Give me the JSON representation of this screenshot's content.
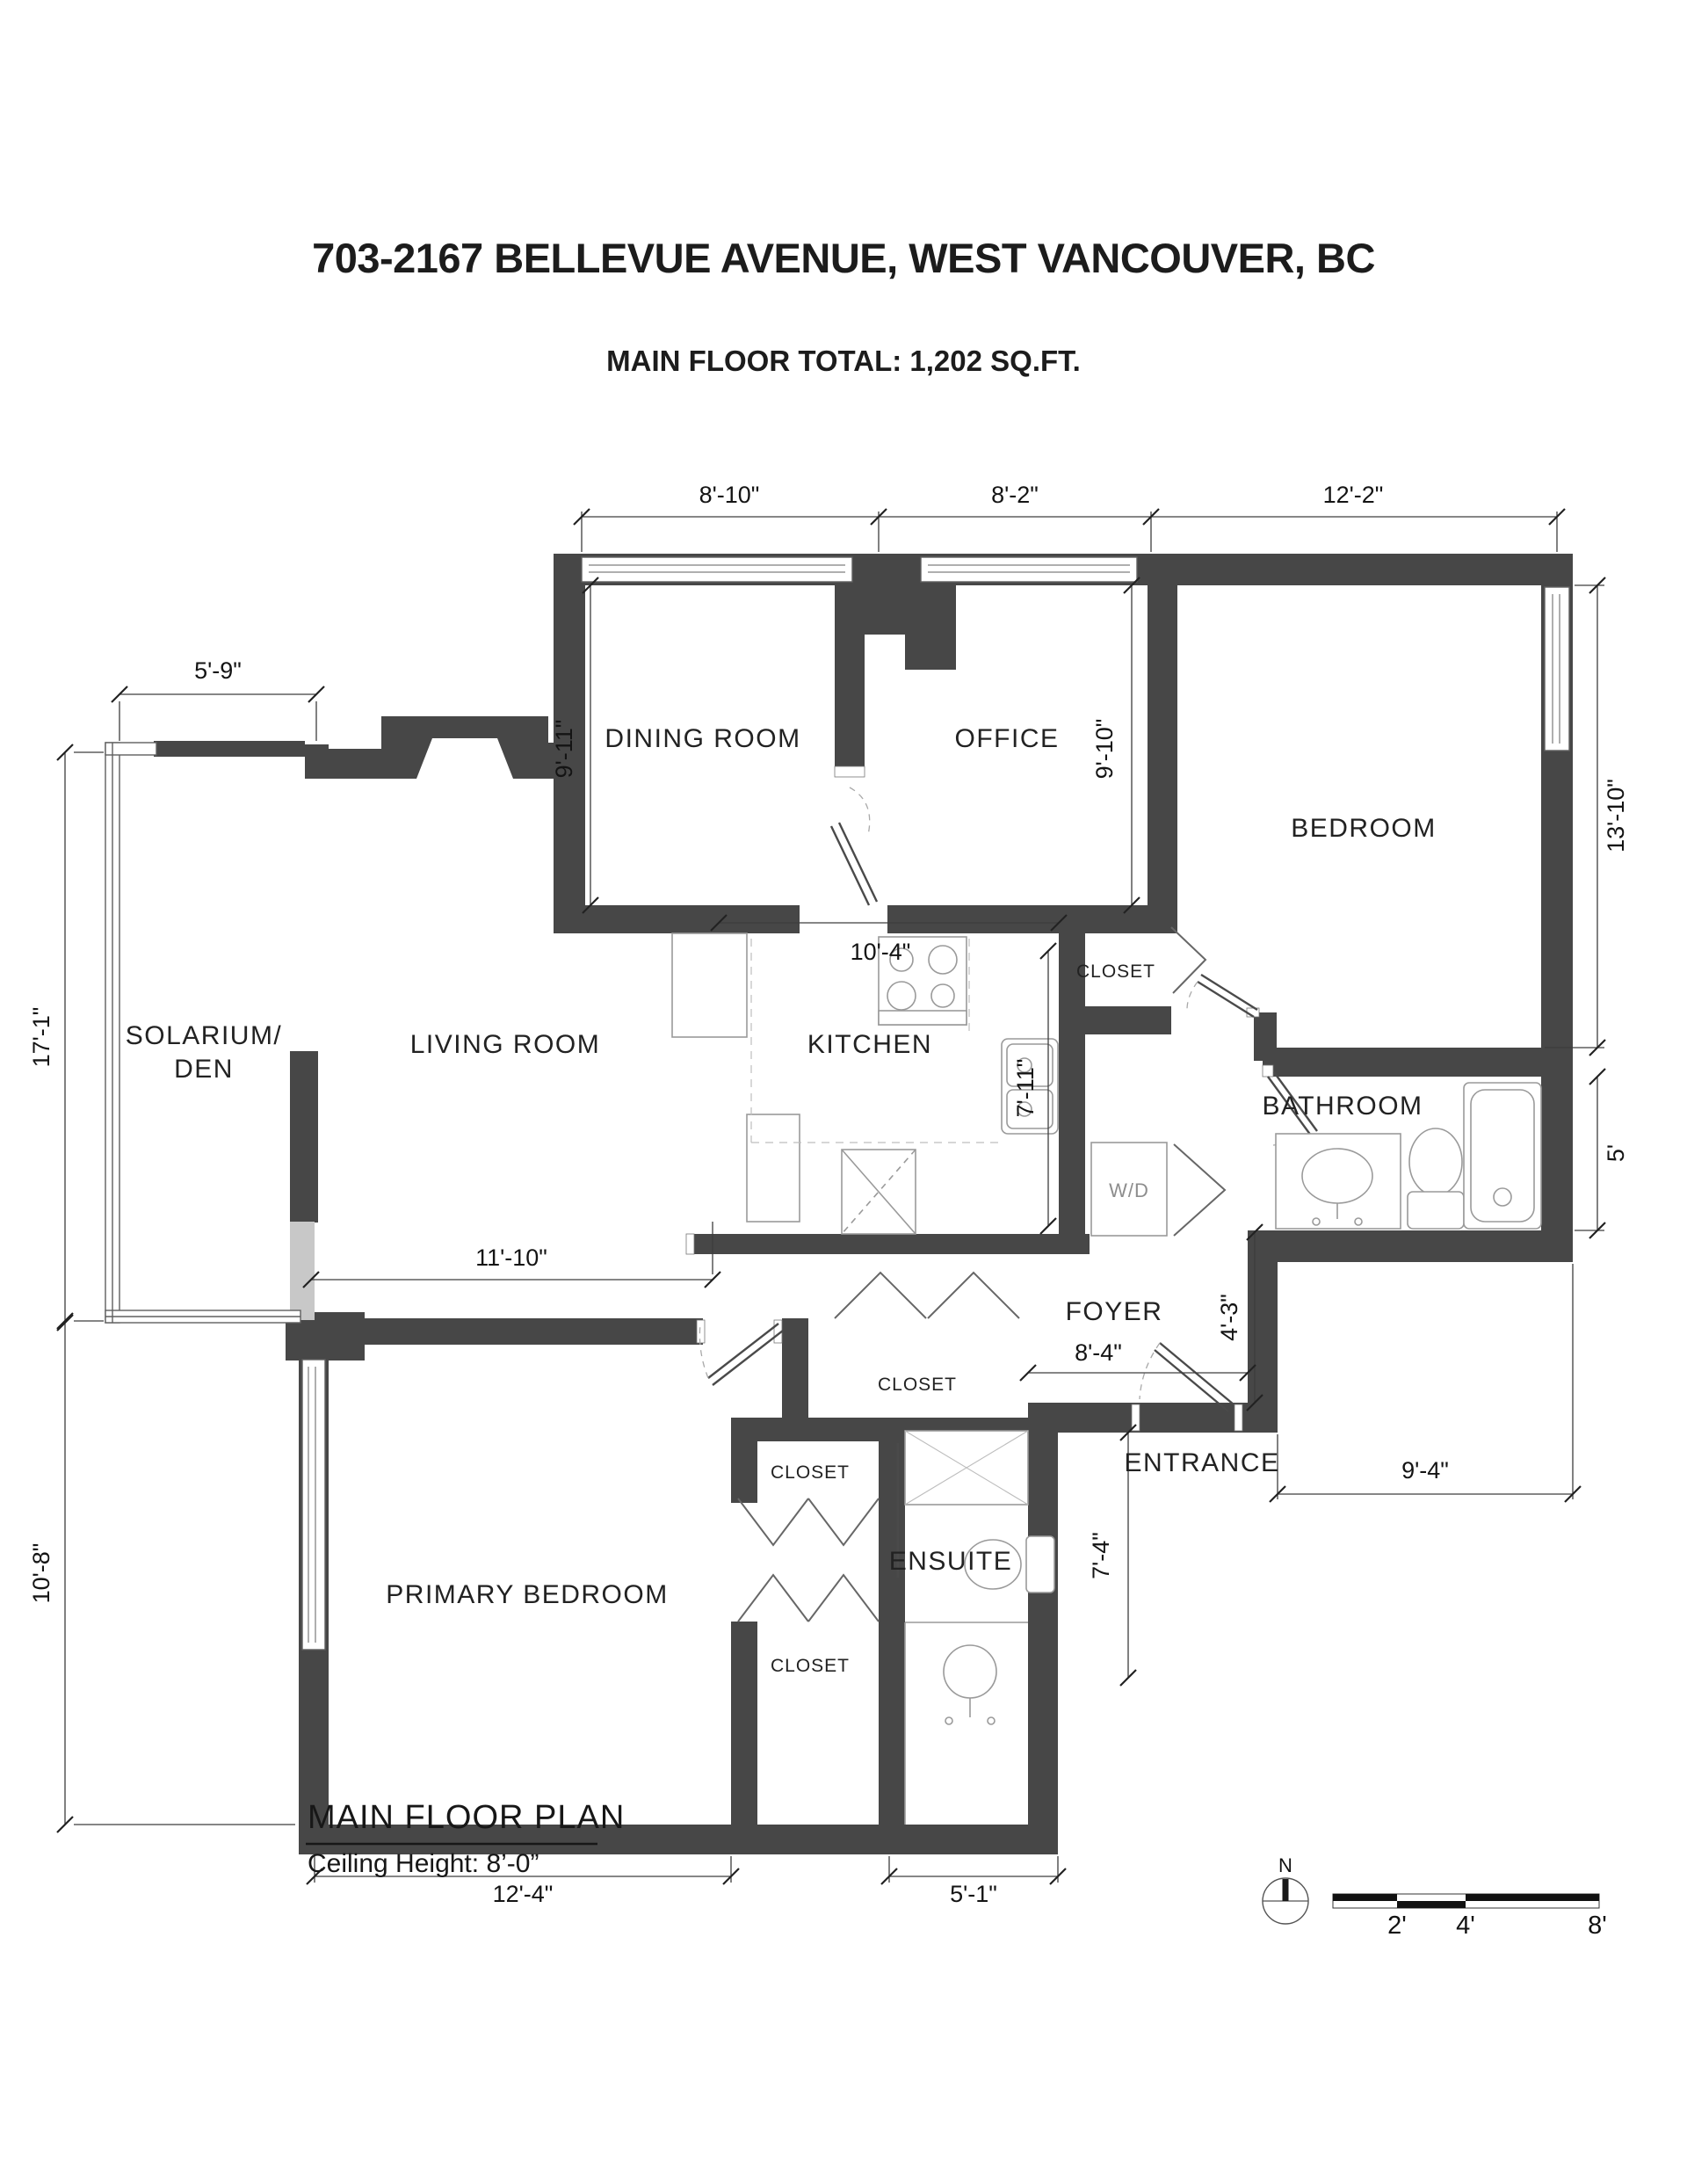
{
  "header": {
    "title": "703-2167 BELLEVUE AVENUE, WEST VANCOUVER, BC",
    "subtitle": "MAIN FLOOR TOTAL:  1,202 SQ.FT."
  },
  "rooms": {
    "dining": "DINING ROOM",
    "office": "OFFICE",
    "bedroom": "BEDROOM",
    "solarium_line1": "SOLARIUM/",
    "solarium_line2": "DEN",
    "living": "LIVING ROOM",
    "kitchen": "KITCHEN",
    "bathroom": "BATHROOM",
    "foyer": "FOYER",
    "entrance": "ENTRANCE",
    "primary": "PRIMARY BEDROOM",
    "ensuite": "ENSUITE",
    "closet_bedroom": "CLOSET",
    "closet_foyer": "CLOSET",
    "closet_primary_a": "CLOSET",
    "closet_primary_b": "CLOSET",
    "washer_dryer": "W/D"
  },
  "dims": {
    "d8_10": "8'-10\"",
    "d8_2": "8'-2\"",
    "d12_2": "12'-2\"",
    "d5_9": "5'-9\"",
    "d17_1": "17'-1\"",
    "d10_8": "10'-8\"",
    "d9_11": "9'-11\"",
    "d9_10": "9'-10\"",
    "d13_10": "13'-10\"",
    "d5": "5'",
    "d10_4": "10'-4\"",
    "d7_11": "7'-11\"",
    "d11_10": "11'-10\"",
    "d4_3": "4'-3\"",
    "d8_4": "8'-4\"",
    "d9_4": "9'-4\"",
    "d7_4": "7'-4\"",
    "d12_4": "12'-4\"",
    "d5_1": "5'-1\""
  },
  "footer": {
    "plan_title": "MAIN FLOOR PLAN",
    "ceiling": "Ceiling Height: 8’-0”",
    "north": "N",
    "scale_2": "2'",
    "scale_4": "4'",
    "scale_8": "8'"
  }
}
